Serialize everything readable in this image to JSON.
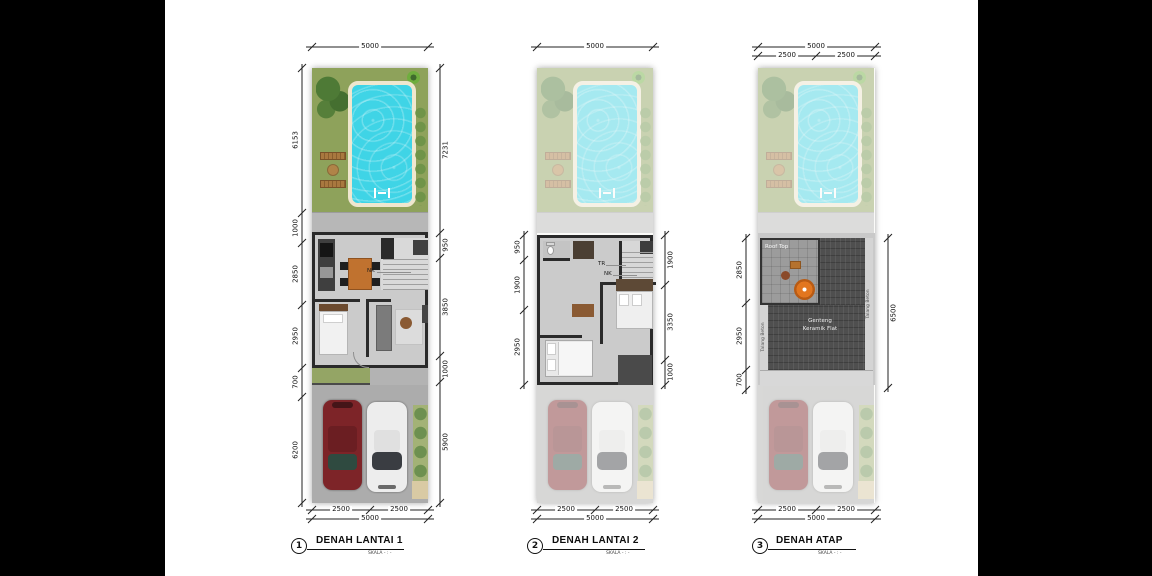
{
  "document": {
    "type": "architectural-floor-plan-sheet"
  },
  "colors": {
    "letterbox": "#000000",
    "paper": "#ffffff",
    "grass": "#8ea25b",
    "pool_water": "#3fd4e6",
    "pool_deck": "#efe7cf",
    "floor": "#cbcbcb",
    "wall": "#2a2a2a",
    "driveway": "#acacac",
    "car_red": "#7d2428",
    "car_white": "#ededed",
    "roof_tile": "#4f4f4f",
    "roof_terrace": "#9c9c9c",
    "parasol": "#e2761f",
    "dining_table": "#c0722f"
  },
  "plans": [
    {
      "number": "1",
      "title": "DENAH LANTAI 1",
      "scale": "SKALA - : -",
      "dim_top_total": "5000",
      "dim_left": [
        "6153",
        "1000",
        "2850",
        "2950",
        "700",
        "6200"
      ],
      "dim_right": [
        "7231",
        "950",
        "3850",
        "1000",
        "5900"
      ],
      "dim_bottom": [
        "2500",
        "2500"
      ],
      "dim_bottom_total": "5000",
      "callouts": {
        "nk": "NK"
      }
    },
    {
      "number": "2",
      "title": "DENAH LANTAI 2",
      "scale": "SKALA - : -",
      "dim_top_total": "5000",
      "dim_left": [
        "950",
        "1900",
        "2950"
      ],
      "dim_right": [
        "1900",
        "3350",
        "1000"
      ],
      "dim_bottom": [
        "2500",
        "2500"
      ],
      "dim_bottom_total": "5000",
      "callouts": {
        "tr": "TR",
        "nk": "NK"
      }
    },
    {
      "number": "3",
      "title": "DENAH ATAP",
      "scale": "SKALA - : -",
      "dim_top_total": "5000",
      "dim_top_sub": [
        "2500",
        "2500"
      ],
      "dim_left": [
        "2850",
        "2950",
        "700"
      ],
      "dim_right": [
        "6500"
      ],
      "dim_bottom": [
        "2500",
        "2500"
      ],
      "dim_bottom_total": "5000",
      "callouts": {
        "roof_area": "Roof Top",
        "roof_material_1": "Genteng",
        "roof_material_2": "Keramik Flat",
        "gutter_left": "Talang Beton",
        "gutter_right": "Talang Beton"
      }
    }
  ]
}
